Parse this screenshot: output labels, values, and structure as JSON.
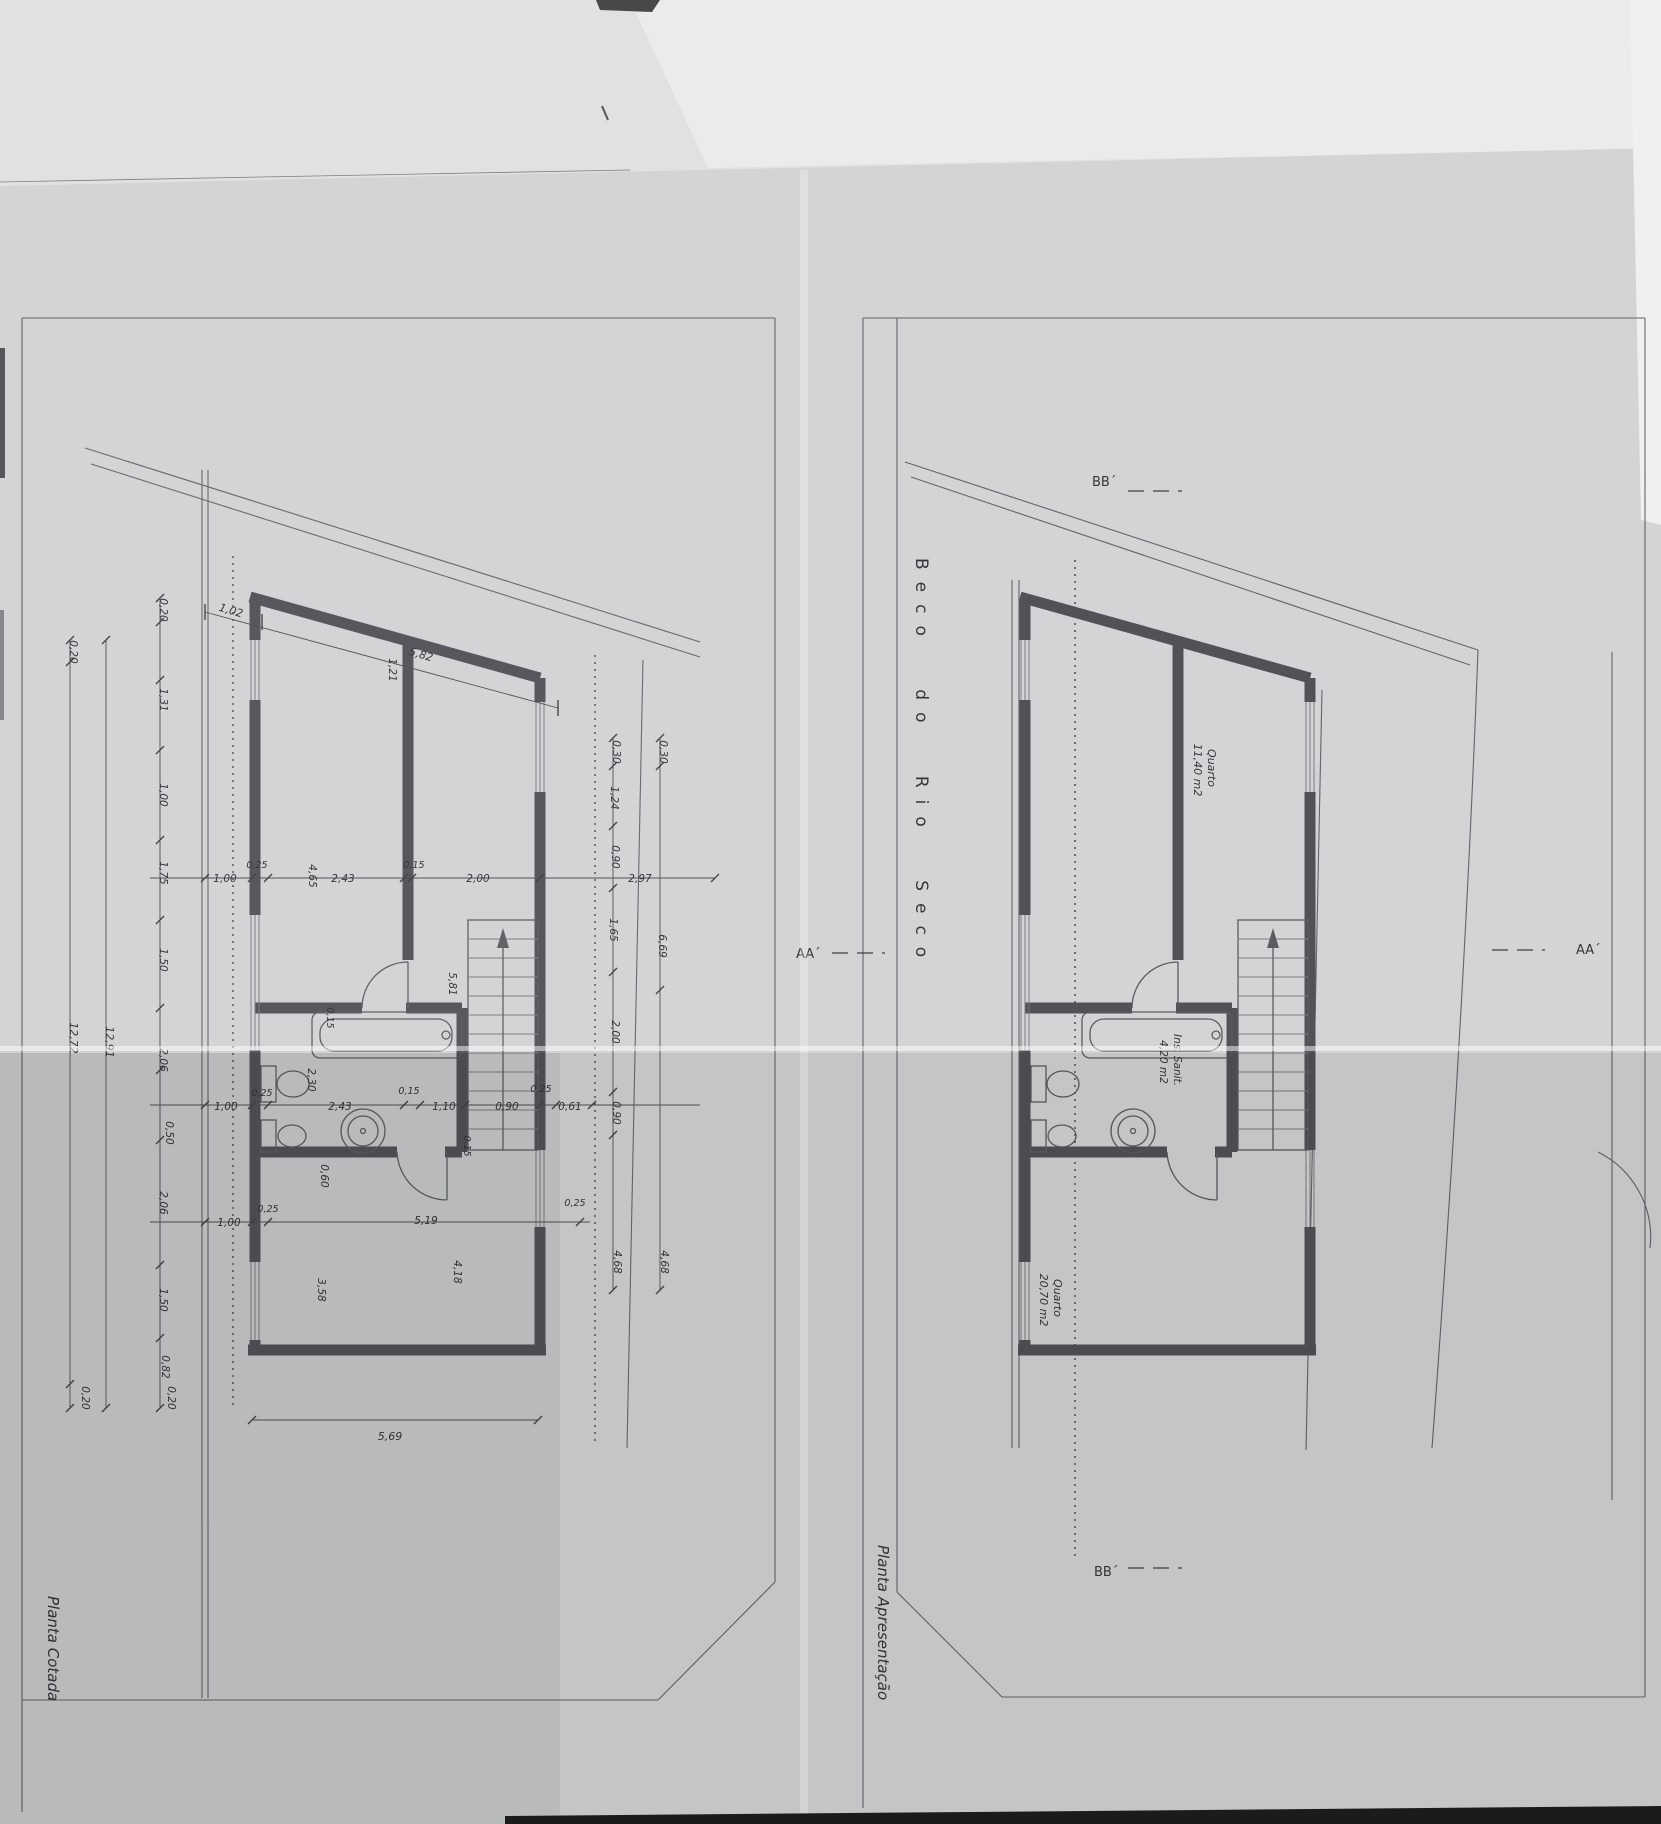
{
  "document": {
    "type": "architectural-floor-plan-photo",
    "street_name": "Beco do Rio Seco",
    "sheet_left_title": "Planta Cotada",
    "sheet_right_title": "Planta Apresentação"
  },
  "colors": {
    "paper": "#d2d4d6",
    "paper_light": "#dfe1e2",
    "paper_bright": "#eef0f1",
    "line": "#63656a",
    "wall": "#515257",
    "text": "#35373b",
    "black": "#1b1b1d"
  },
  "rooms": [
    {
      "name": "Quarto",
      "area": "11,40 m2"
    },
    {
      "name": "Ins. Sanit.",
      "area": "4,20 m2"
    },
    {
      "name": "Quarto",
      "area": "20,70 m2"
    }
  ],
  "section_markers": [
    "AA´",
    "AA´",
    "BB´",
    "BB´"
  ],
  "dimension_chains": {
    "top_slanted": [
      "1,02",
      "5,82"
    ],
    "bottom": [
      "5,69"
    ],
    "left_outer": [
      "0,20",
      "12,72",
      "0,20"
    ],
    "left_overall": [
      "12,91"
    ],
    "left_detail": [
      "0,20",
      "1,31",
      "1,00",
      "1,75",
      "1,50",
      "2,06",
      "0,50",
      "2,06",
      "1,50",
      "0,82",
      "0,20"
    ],
    "right_chain_a": [
      "0,30",
      "1,24",
      "0,90",
      "1,65",
      "2,00",
      "0,90",
      "4,68"
    ],
    "right_chain_b": [
      "0,30",
      "2,97",
      "6,69",
      "4,68"
    ],
    "interior_upper": [
      "1,00",
      "0,25",
      "4,65",
      "2,43",
      "0,15",
      "2,00"
    ],
    "interior_middle": [
      "1,00",
      "0,25",
      "2,30",
      "2,43",
      "0,15",
      "1,10",
      "0,90",
      "0,25",
      "0,61",
      "0,15",
      "0,15",
      "0,60",
      "5,81",
      "1,21"
    ],
    "interior_lower": [
      "1,00",
      "0,25",
      "5,19",
      "0,25",
      "3,58",
      "4,18"
    ]
  },
  "labels": [
    {
      "t": "Planta Cotada",
      "x": 48,
      "y": 1596,
      "r": 90,
      "fs": 15,
      "a": "start",
      "i": 1,
      "n": "sheet-title-left"
    },
    {
      "t": "Planta Apresentação",
      "x": 878,
      "y": 1545,
      "r": 90,
      "fs": 15,
      "a": "start",
      "i": 1,
      "n": "sheet-title-right"
    },
    {
      "t": "Beco do Rio Seco",
      "x": 916,
      "y": 558,
      "r": 90,
      "fs": 17,
      "a": "start",
      "ls": 12,
      "ws": 24,
      "n": "street-name"
    },
    {
      "t": "AA´",
      "x": 796,
      "y": 958,
      "fs": 13,
      "a": "start",
      "n": "section-marker-aa-left"
    },
    {
      "t": "AA´",
      "x": 1576,
      "y": 954,
      "fs": 13,
      "a": "start",
      "n": "section-marker-aa-right"
    },
    {
      "t": "BB´",
      "x": 1092,
      "y": 486,
      "fs": 13,
      "a": "start",
      "n": "section-marker-bb-top"
    },
    {
      "t": "BB´",
      "x": 1094,
      "y": 1576,
      "fs": 13,
      "a": "start",
      "n": "section-marker-bb-bottom"
    },
    {
      "t": "Quarto",
      "x": 1208,
      "y": 768,
      "r": 90,
      "fs": 11,
      "i": 1,
      "n": "room-name-label"
    },
    {
      "t": "11,40 m2",
      "x": 1194,
      "y": 770,
      "r": 90,
      "fs": 11,
      "i": 1,
      "n": "room-area-label"
    },
    {
      "t": "Ins. Sanit.",
      "x": 1174,
      "y": 1060,
      "r": 90,
      "fs": 10.5,
      "i": 1,
      "n": "room-name-label"
    },
    {
      "t": "4,20 m2",
      "x": 1160,
      "y": 1062,
      "r": 90,
      "fs": 10.5,
      "i": 1,
      "n": "room-area-label"
    },
    {
      "t": "Quarto",
      "x": 1054,
      "y": 1298,
      "r": 90,
      "fs": 11,
      "i": 1,
      "n": "room-name-label"
    },
    {
      "t": "20,70 m2",
      "x": 1040,
      "y": 1300,
      "r": 90,
      "fs": 11,
      "i": 1,
      "n": "room-area-label"
    },
    {
      "t": "1,02",
      "x": 230,
      "y": 614,
      "r": 16,
      "fs": 11,
      "i": 1,
      "n": "dimension-label"
    },
    {
      "t": "5,82",
      "x": 420,
      "y": 658,
      "r": 16,
      "fs": 11,
      "i": 1,
      "n": "dimension-label"
    },
    {
      "t": "5,69",
      "x": 390,
      "y": 1440,
      "fs": 11,
      "i": 1,
      "n": "dimension-label"
    },
    {
      "t": "0,20",
      "x": 70,
      "y": 652,
      "r": 90,
      "fs": 10.5,
      "i": 1,
      "n": "dimension-label"
    },
    {
      "t": "12,72",
      "x": 70,
      "y": 1038,
      "r": 90,
      "fs": 11,
      "i": 1,
      "n": "overall-dimension-label"
    },
    {
      "t": "0,20",
      "x": 82,
      "y": 1398,
      "r": 90,
      "fs": 10.5,
      "i": 1,
      "n": "dimension-label"
    },
    {
      "t": "12,91",
      "x": 106,
      "y": 1042,
      "r": 90,
      "fs": 11,
      "i": 1,
      "n": "overall-dimension-label"
    },
    {
      "t": "0,20",
      "x": 160,
      "y": 610,
      "r": 90,
      "fs": 10.5,
      "i": 1,
      "n": "dimension-label"
    },
    {
      "t": "1,31",
      "x": 160,
      "y": 700,
      "r": 90,
      "fs": 10.5,
      "i": 1,
      "n": "dimension-label"
    },
    {
      "t": "1,00",
      "x": 160,
      "y": 795,
      "r": 90,
      "fs": 10.5,
      "i": 1,
      "n": "dimension-label"
    },
    {
      "t": "1,75",
      "x": 160,
      "y": 873,
      "r": 90,
      "fs": 10.5,
      "i": 1,
      "n": "dimension-label"
    },
    {
      "t": "1,50",
      "x": 160,
      "y": 960,
      "r": 90,
      "fs": 10.5,
      "i": 1,
      "n": "dimension-label"
    },
    {
      "t": "2,06",
      "x": 160,
      "y": 1060,
      "r": 90,
      "fs": 10.5,
      "i": 1,
      "n": "dimension-label"
    },
    {
      "t": "0,50",
      "x": 166,
      "y": 1133,
      "r": 90,
      "fs": 10.5,
      "i": 1,
      "n": "dimension-label"
    },
    {
      "t": "2,06",
      "x": 160,
      "y": 1203,
      "r": 90,
      "fs": 10.5,
      "i": 1,
      "n": "dimension-label"
    },
    {
      "t": "1,50",
      "x": 160,
      "y": 1300,
      "r": 90,
      "fs": 10.5,
      "i": 1,
      "n": "dimension-label"
    },
    {
      "t": "0,82",
      "x": 162,
      "y": 1367,
      "r": 90,
      "fs": 10.5,
      "i": 1,
      "n": "dimension-label"
    },
    {
      "t": "0,20",
      "x": 168,
      "y": 1398,
      "r": 90,
      "fs": 10.5,
      "i": 1,
      "n": "dimension-label"
    },
    {
      "t": "0,30",
      "x": 613,
      "y": 752,
      "r": 90,
      "fs": 10.5,
      "i": 1,
      "n": "dimension-label"
    },
    {
      "t": "1,24",
      "x": 611,
      "y": 798,
      "r": 90,
      "fs": 10.5,
      "i": 1,
      "n": "dimension-label"
    },
    {
      "t": "0,90",
      "x": 612,
      "y": 857,
      "r": 90,
      "fs": 10.5,
      "i": 1,
      "n": "dimension-label"
    },
    {
      "t": "1,65",
      "x": 610,
      "y": 930,
      "r": 90,
      "fs": 10.5,
      "i": 1,
      "n": "dimension-label"
    },
    {
      "t": "2,00",
      "x": 612,
      "y": 1032,
      "r": 90,
      "fs": 10.5,
      "i": 1,
      "n": "dimension-label"
    },
    {
      "t": "0,90",
      "x": 613,
      "y": 1113,
      "r": 90,
      "fs": 10.5,
      "i": 1,
      "n": "dimension-label"
    },
    {
      "t": "4,68",
      "x": 614,
      "y": 1262,
      "r": 90,
      "fs": 10.5,
      "i": 1,
      "n": "dimension-label"
    },
    {
      "t": "0,30",
      "x": 660,
      "y": 752,
      "r": 90,
      "fs": 10.5,
      "i": 1,
      "n": "dimension-label"
    },
    {
      "t": "2,97",
      "x": 640,
      "y": 882,
      "fs": 10.5,
      "i": 1,
      "n": "dimension-label"
    },
    {
      "t": "6,69",
      "x": 659,
      "y": 946,
      "r": 90,
      "fs": 10.5,
      "i": 1,
      "n": "dimension-label"
    },
    {
      "t": "4,68",
      "x": 661,
      "y": 1262,
      "r": 90,
      "fs": 10.5,
      "i": 1,
      "n": "dimension-label"
    },
    {
      "t": "1,00",
      "x": 225,
      "y": 882,
      "fs": 10.5,
      "i": 1,
      "n": "dimension-label"
    },
    {
      "t": "0,25",
      "x": 257,
      "y": 868,
      "fs": 9.5,
      "i": 1,
      "n": "dimension-label"
    },
    {
      "t": "4,65",
      "x": 309,
      "y": 876,
      "r": 90,
      "fs": 10.5,
      "i": 1,
      "n": "dimension-label"
    },
    {
      "t": "2,43",
      "x": 343,
      "y": 882,
      "fs": 10.5,
      "i": 1,
      "n": "dimension-label"
    },
    {
      "t": "0,15",
      "x": 414,
      "y": 868,
      "fs": 9.5,
      "i": 1,
      "n": "dimension-label"
    },
    {
      "t": "2,00",
      "x": 478,
      "y": 882,
      "fs": 10.5,
      "i": 1,
      "n": "dimension-label"
    },
    {
      "t": "1,21",
      "x": 389,
      "y": 670,
      "r": 90,
      "fs": 10.5,
      "i": 1,
      "n": "dimension-label"
    },
    {
      "t": "5,81",
      "x": 449,
      "y": 984,
      "r": 90,
      "fs": 10.5,
      "i": 1,
      "n": "dimension-label"
    },
    {
      "t": "0,15",
      "x": 327,
      "y": 1018,
      "r": 90,
      "fs": 9.5,
      "i": 1,
      "n": "dimension-label"
    },
    {
      "t": "2,30",
      "x": 308,
      "y": 1080,
      "r": 90,
      "fs": 10.5,
      "i": 1,
      "n": "dimension-label"
    },
    {
      "t": "1,00",
      "x": 226,
      "y": 1110,
      "fs": 10.5,
      "i": 1,
      "n": "dimension-label"
    },
    {
      "t": "0,25",
      "x": 262,
      "y": 1096,
      "fs": 9.5,
      "i": 1,
      "n": "dimension-label"
    },
    {
      "t": "2,43",
      "x": 340,
      "y": 1110,
      "fs": 10.5,
      "i": 1,
      "n": "dimension-label"
    },
    {
      "t": "0,15",
      "x": 409,
      "y": 1094,
      "fs": 9.5,
      "i": 1,
      "n": "dimension-label"
    },
    {
      "t": "1,10",
      "x": 444,
      "y": 1110,
      "fs": 10.5,
      "i": 1,
      "n": "dimension-label"
    },
    {
      "t": "0,90",
      "x": 507,
      "y": 1110,
      "fs": 10.5,
      "i": 1,
      "n": "dimension-label"
    },
    {
      "t": "0,25",
      "x": 541,
      "y": 1092,
      "fs": 9.5,
      "i": 1,
      "n": "dimension-label"
    },
    {
      "t": "0,61",
      "x": 570,
      "y": 1110,
      "fs": 10.5,
      "i": 1,
      "n": "dimension-label"
    },
    {
      "t": "0,15",
      "x": 464,
      "y": 1146,
      "r": 90,
      "fs": 9.5,
      "i": 1,
      "n": "dimension-label"
    },
    {
      "t": "0,60",
      "x": 321,
      "y": 1176,
      "r": 90,
      "fs": 10.5,
      "i": 1,
      "n": "dimension-label"
    },
    {
      "t": "1,00",
      "x": 229,
      "y": 1226,
      "fs": 10.5,
      "i": 1,
      "n": "dimension-label"
    },
    {
      "t": "0,25",
      "x": 268,
      "y": 1212,
      "fs": 9.5,
      "i": 1,
      "n": "dimension-label"
    },
    {
      "t": "5,19",
      "x": 426,
      "y": 1224,
      "fs": 10.5,
      "i": 1,
      "n": "dimension-label"
    },
    {
      "t": "0,25",
      "x": 575,
      "y": 1206,
      "fs": 9.5,
      "i": 1,
      "n": "dimension-label"
    },
    {
      "t": "3,58",
      "x": 318,
      "y": 1290,
      "r": 90,
      "fs": 10.5,
      "i": 1,
      "n": "dimension-label"
    },
    {
      "t": "4,18",
      "x": 454,
      "y": 1272,
      "r": 90,
      "fs": 10.5,
      "i": 1,
      "n": "dimension-label"
    }
  ]
}
